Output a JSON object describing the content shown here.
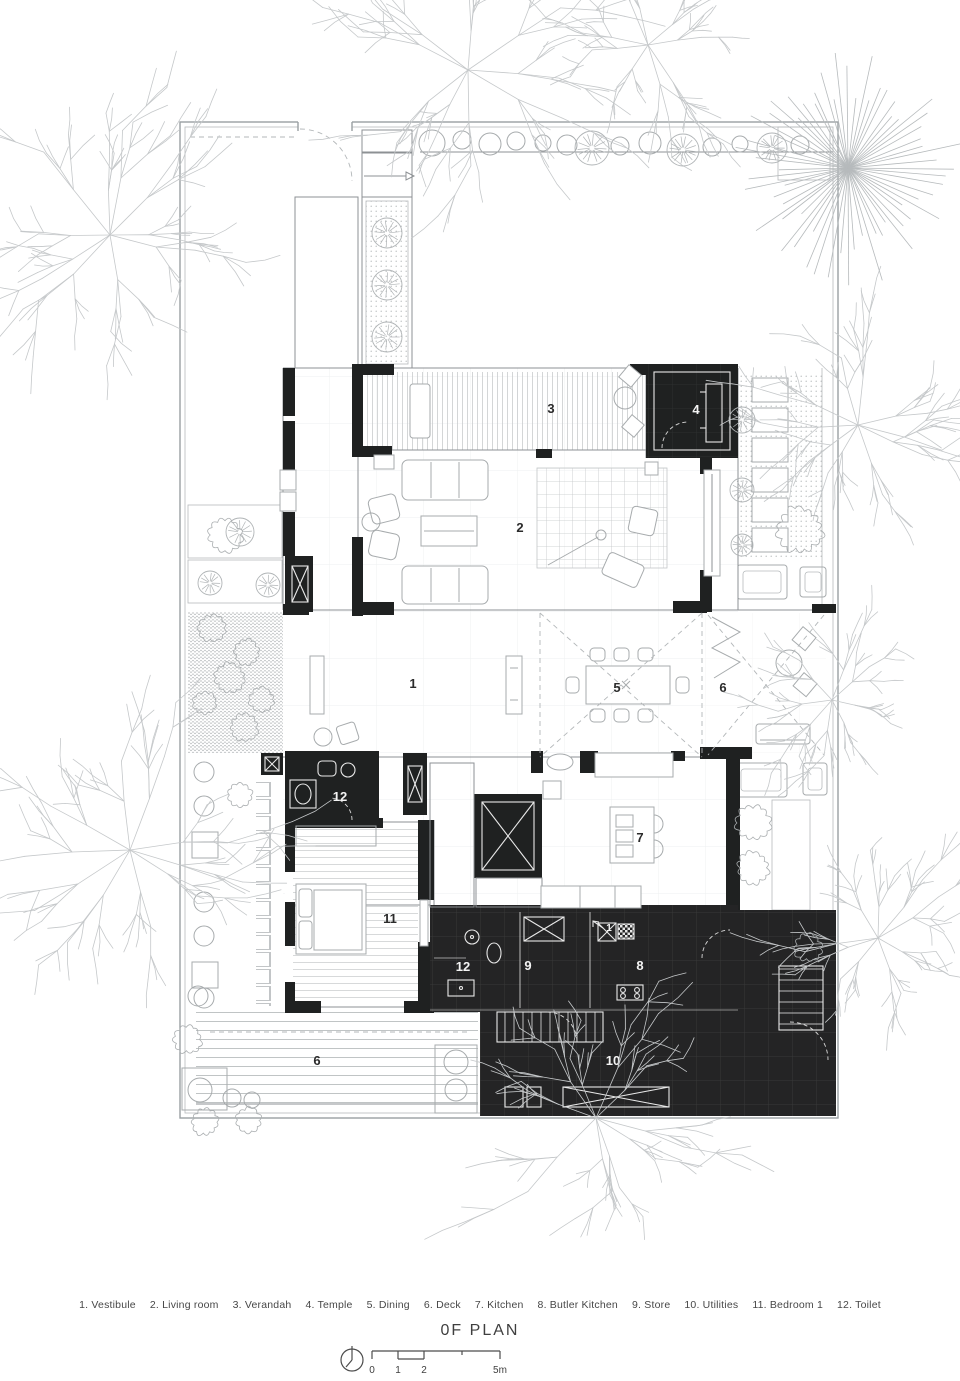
{
  "title": "0F PLAN",
  "legend": [
    "1. Vestibule",
    "2. Living room",
    "3. Verandah",
    "4. Temple",
    "5. Dining",
    "6. Deck",
    "7. Kitchen",
    "8. Butler Kitchen",
    "9. Store",
    "10. Utilities",
    "11. Bedroom 1",
    "12. Toilet"
  ],
  "rooms": [
    {
      "num": "1",
      "name": "Vestibule"
    },
    {
      "num": "2",
      "name": "Living room"
    },
    {
      "num": "3",
      "name": "Verandah"
    },
    {
      "num": "4",
      "name": "Temple"
    },
    {
      "num": "5",
      "name": "Dining"
    },
    {
      "num": "6",
      "name": "Deck"
    },
    {
      "num": "7",
      "name": "Kitchen"
    },
    {
      "num": "8",
      "name": "Butler Kitchen"
    },
    {
      "num": "9",
      "name": "Store"
    },
    {
      "num": "10",
      "name": "Utilities"
    },
    {
      "num": "11",
      "name": "Bedroom 1"
    },
    {
      "num": "12",
      "name": "Toilet"
    },
    {
      "num": "12",
      "name": "Toilet"
    },
    {
      "num": "6",
      "name": "Deck"
    }
  ],
  "markers": {
    "level": {
      "num": "1"
    }
  },
  "scale_bar": {
    "ticks": [
      "0",
      "1",
      "2",
      "5m"
    ]
  },
  "colors": {
    "wall": "#1f2121",
    "dark_room": "#242425",
    "drawing_line": "#8d9194",
    "faint_line": "#c6c9cb",
    "text": "#3f3f3f"
  }
}
